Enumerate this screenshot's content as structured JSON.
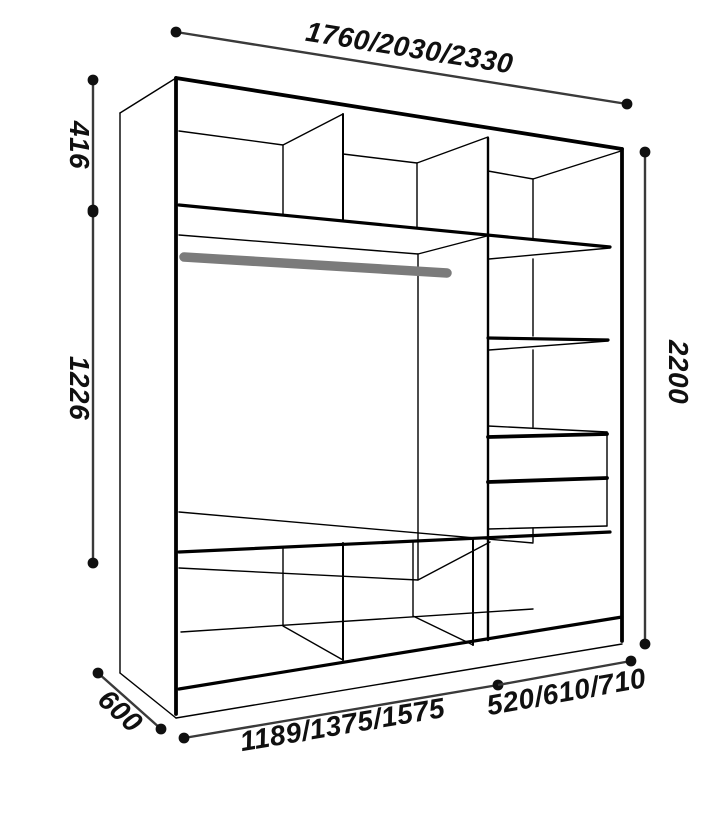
{
  "diagram": {
    "type": "wardrobe-dimension-drawing",
    "colors": {
      "line": "#000000",
      "dimension_line": "#3a3a3a",
      "dimension_dot": "#101010",
      "label_text": "#101010",
      "hanging_rod": "#7b7b7b",
      "background": "#ffffff"
    },
    "dimensions": {
      "top_width": {
        "label": "1760/2030/2330"
      },
      "upper_left_height": {
        "label": "416"
      },
      "lower_left_height": {
        "label": "1226"
      },
      "right_height": {
        "label": "2200"
      },
      "depth": {
        "label": "600"
      },
      "bottom_left_width": {
        "label": "1189/1375/1575"
      },
      "bottom_right_width": {
        "label": "520/610/710"
      }
    },
    "features": {
      "hanging_rod": "gray clothes rail in main compartment",
      "drawer_count": 2,
      "top_compartments": 3,
      "right_column_shelves": 2,
      "bottom_compartments": 3
    }
  }
}
